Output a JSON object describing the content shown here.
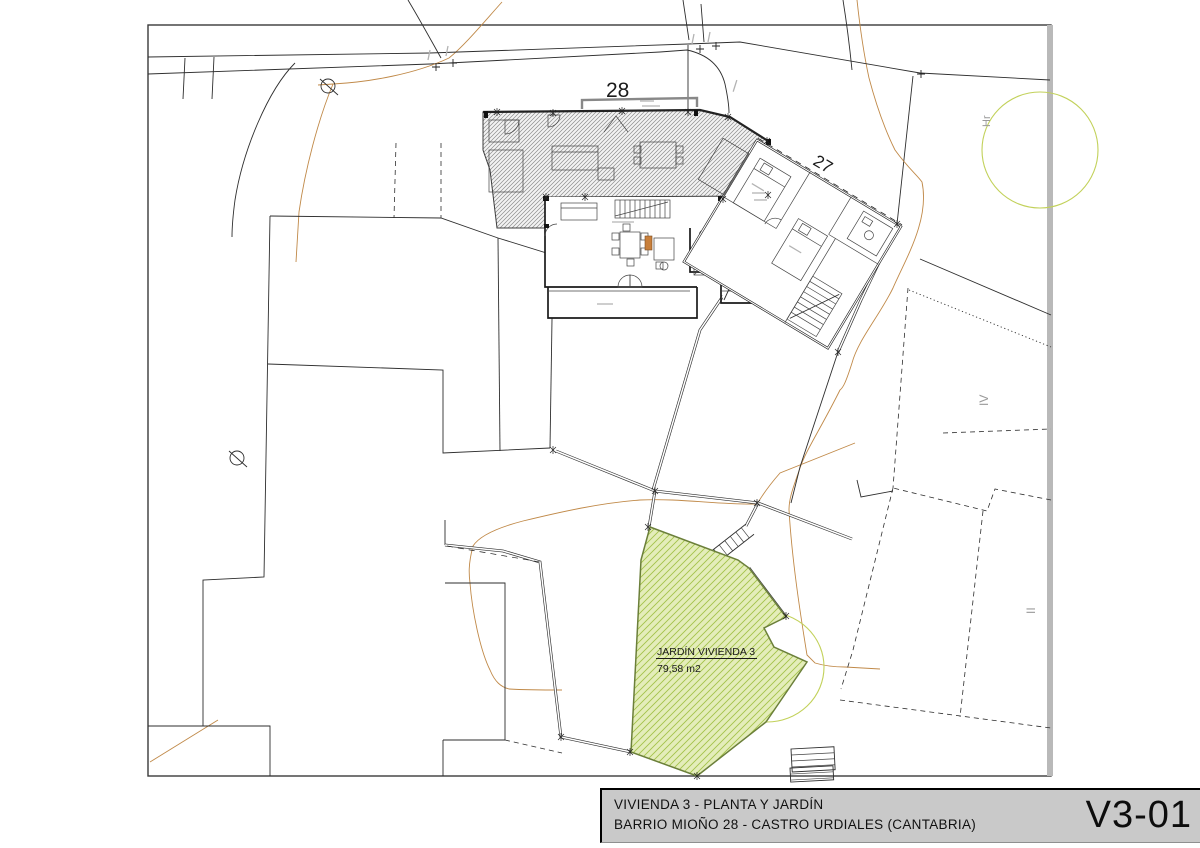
{
  "title_block": {
    "line1": "VIVIENDA 3 - PLANTA Y JARDÍN",
    "line2": "BARRIO MIOÑO 28 - CASTRO URDIALES (CANTABRIA)",
    "sheet_code": "V3-01"
  },
  "plan": {
    "labels": {
      "plot_28": "28",
      "plot_27": "27",
      "hr": "Hr",
      "iv": "IV",
      "ii": "II"
    },
    "garden": {
      "name": "JARDÍN VIVIENDA 3",
      "area": "79,58 m2"
    },
    "symbols": {
      "diameter_marks": "Ø"
    }
  },
  "colors": {
    "titlebar_bg": "#c9c9c9",
    "contour": "#c08948",
    "canopy": "#c2d15a",
    "garden_fill": "#e4edba",
    "garden_hatch": "#a3c24a",
    "garden_outline": "#6b7f3a",
    "hatch_bg": "#f3f3f3",
    "hatch_line": "#8c8c8c",
    "frame_line": "#3a3a3a"
  }
}
